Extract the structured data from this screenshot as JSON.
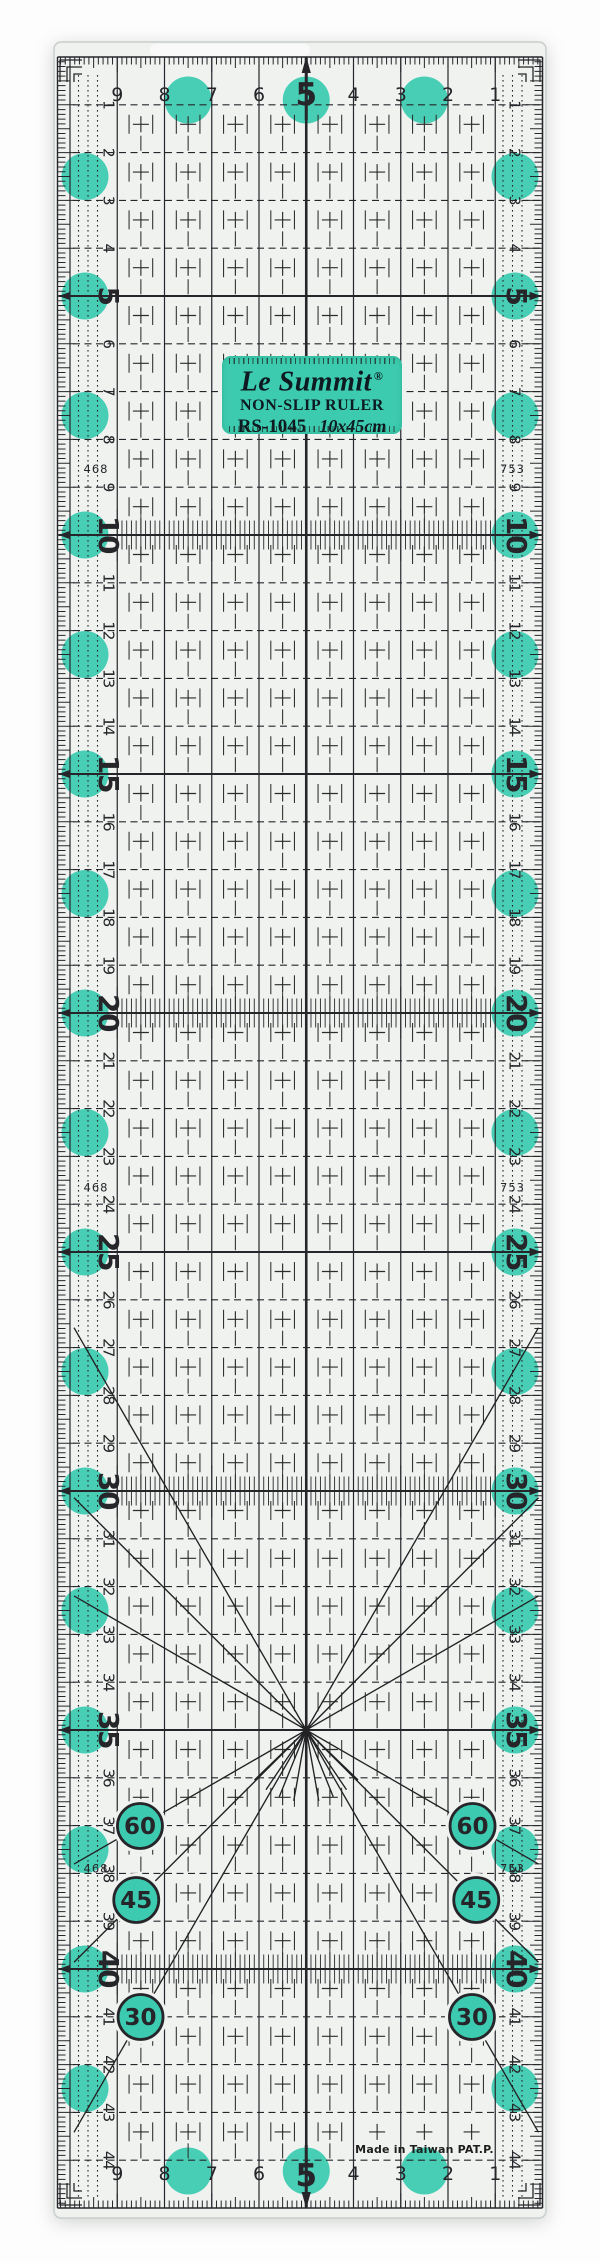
{
  "product": "Le Summit non-slip quilting ruler RS-1045",
  "label": {
    "brand": "Le Summit",
    "registered_mark": "®",
    "product_line": "NON-SLIP RULER",
    "model": "RS-1045",
    "dimensions": "10x45cm"
  },
  "footer": {
    "origin_text": "Made in Taiwan PAT.P."
  },
  "scales": {
    "top_numbers": [
      "9",
      "8",
      "7",
      "6",
      "5",
      "4",
      "3",
      "2",
      "1"
    ],
    "bottom_numbers": [
      "9",
      "8",
      "7",
      "6",
      "5",
      "4",
      "3",
      "2",
      "1"
    ],
    "top_bold_number": "5",
    "side_numbers_from": 1,
    "side_numbers_to": 44,
    "side_bold_numbers": [
      "5",
      "10",
      "15",
      "20",
      "25",
      "30",
      "35",
      "40"
    ],
    "left_seam_guide_label": "468",
    "right_seam_guide_label": "753"
  },
  "angle_markings": [
    "60",
    "45",
    "30"
  ],
  "colors": {
    "teal": "#3ccbb1",
    "label_bg": "#3ccbae",
    "ink": "#26262a",
    "plastic": "#f0f2f0",
    "plastic_edge": "#c9cfcc",
    "page_background": "#fdfdfd"
  }
}
